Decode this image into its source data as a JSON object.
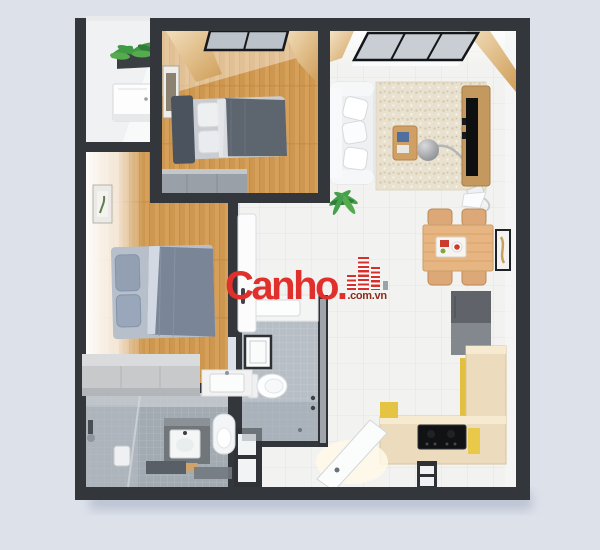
{
  "image": {
    "kind": "3d-top-down-apartment-floor-plan-render",
    "width": 600,
    "height": 550,
    "background_color": "#dce1ea",
    "wall_color": "#33373c"
  },
  "watermark": {
    "brand": "Canho.",
    "domain": ".com.vn",
    "brand_color": "#e1302c",
    "domain_color": "#8c2a1e",
    "logo": "red-striped-buildings-icon"
  },
  "palette": {
    "wood_floor": "#d6a05b",
    "white_tile_floor": "#f2f2f0",
    "bathroom_tile": "#a2aab2",
    "kitchen_counter": "#ecdbbc",
    "kitchen_accent_yellow": "#e5c343",
    "sofa": "#eef0f2",
    "rug": "#e9e1cf",
    "bed_blanket_slate": "#7a8698",
    "wardrobe_gray": "#9aa0a7",
    "plant_green": "#3f9b45"
  },
  "scene": {
    "rooms": [
      {
        "name": "balcony",
        "items": [
          "plants",
          "washing-machine"
        ]
      },
      {
        "name": "bedroom-2",
        "items": [
          "window",
          "wood-curtains",
          "wall-art",
          "single-bed",
          "wardrobe"
        ]
      },
      {
        "name": "living-room",
        "items": [
          "window",
          "wood-beam",
          "sofa",
          "rug",
          "coffee-table",
          "arc-floor-lamp",
          "tv-console",
          "tv",
          "plant"
        ]
      },
      {
        "name": "dining-area",
        "items": [
          "pendant-lamp",
          "dining-table",
          "chairs",
          "food-tray",
          "wall-art"
        ]
      },
      {
        "name": "kitchen",
        "items": [
          "refrigerator",
          "shelf-column",
          "l-shaped-counter",
          "cooktop",
          "step-stool"
        ]
      },
      {
        "name": "master-bedroom",
        "items": [
          "wall-art",
          "double-bed",
          "bench",
          "wash-basin",
          "door"
        ]
      },
      {
        "name": "bathroom-1",
        "items": [
          "vanity-sink",
          "mirror-cabinet",
          "toilet",
          "glass-wall",
          "shower"
        ]
      },
      {
        "name": "bathroom-2",
        "items": [
          "shower-head",
          "small-toilet",
          "vanity-sink",
          "toilet",
          "bath-mats",
          "wood-mat"
        ]
      },
      {
        "name": "entry",
        "items": [
          "open-door"
        ]
      }
    ]
  }
}
